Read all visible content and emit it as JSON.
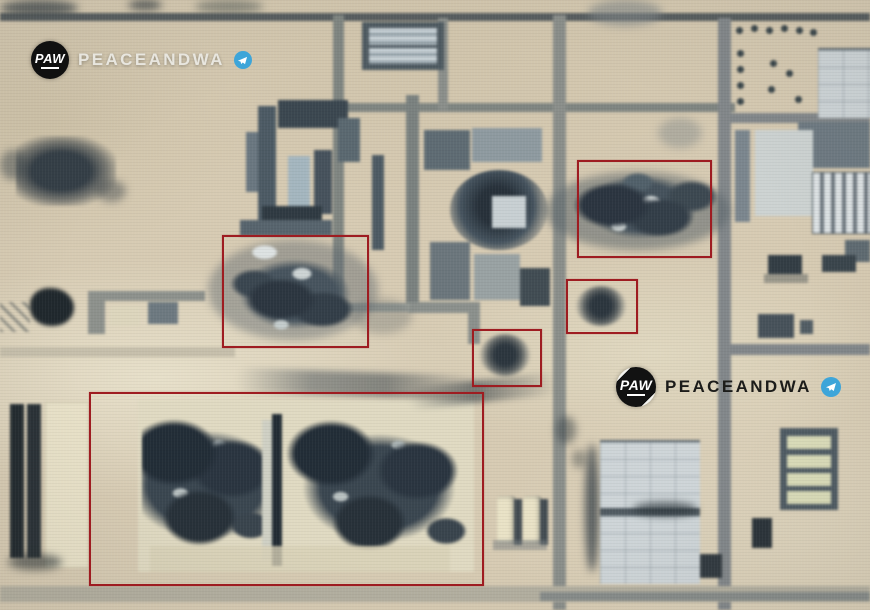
{
  "image": {
    "type": "satellite-photo",
    "description": "Annotated satellite image of an industrial facility with multiple destroyed buildings and impact craters marked by red boxes",
    "background_color": "#d7cbb3",
    "annotation_color": "#9e1c21"
  },
  "watermarks": {
    "brand": "PEACEANDWA",
    "logo_text": "PAW",
    "telegram_color": "#3da5d9",
    "instances": [
      {
        "position": "top-left",
        "text_color": "#e8e6df"
      },
      {
        "position": "middle-right",
        "text_color": "#1c1c1a"
      }
    ]
  },
  "annotations": {
    "boxes": [
      {
        "id": 1,
        "label": "destroyed-building-north-east",
        "x": 577,
        "y": 160,
        "w": 131,
        "h": 94
      },
      {
        "id": 2,
        "label": "destroyed-building-center-west",
        "x": 222,
        "y": 235,
        "w": 143,
        "h": 109
      },
      {
        "id": 3,
        "label": "impact-crater-east",
        "x": 566,
        "y": 279,
        "w": 68,
        "h": 51
      },
      {
        "id": 4,
        "label": "impact-crater-center",
        "x": 472,
        "y": 329,
        "w": 66,
        "h": 54
      },
      {
        "id": 5,
        "label": "destroyed-warehouse-complex-south",
        "x": 89,
        "y": 392,
        "w": 391,
        "h": 190
      }
    ]
  }
}
